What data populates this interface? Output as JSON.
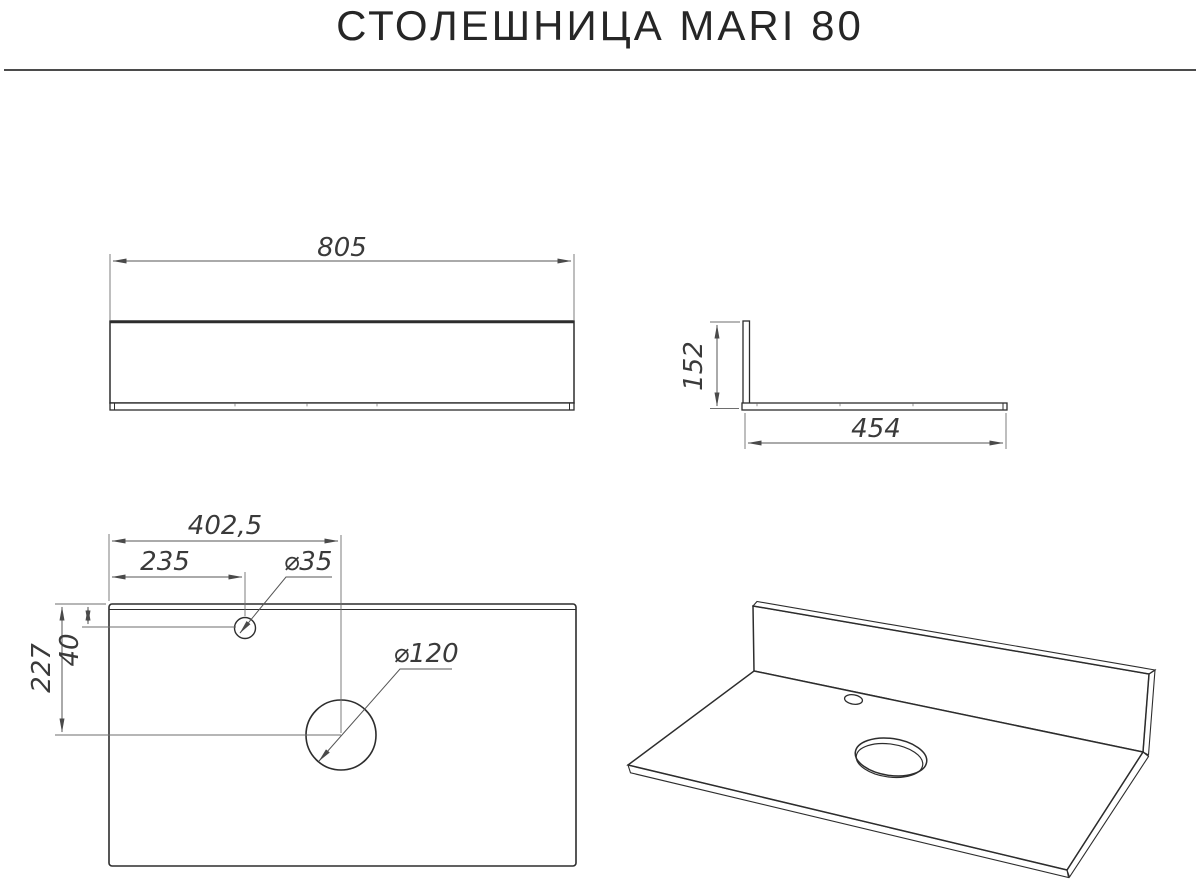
{
  "title": "СТОЛЕШНИЦА MARI 80",
  "front_view": {
    "width": "805"
  },
  "side_view": {
    "height": "152",
    "depth": "454"
  },
  "plan_view": {
    "drain_offset_x": "402,5",
    "faucet_offset_x": "235",
    "drain_offset_y": "227",
    "faucet_offset_y": "40",
    "faucet_hole_diameter": "⌀35",
    "drain_hole_diameter": "⌀120"
  },
  "colors": {
    "background": "#ffffff",
    "object_line": "#2d2d2d",
    "dimension_line": "#565656",
    "text": "#262626"
  }
}
